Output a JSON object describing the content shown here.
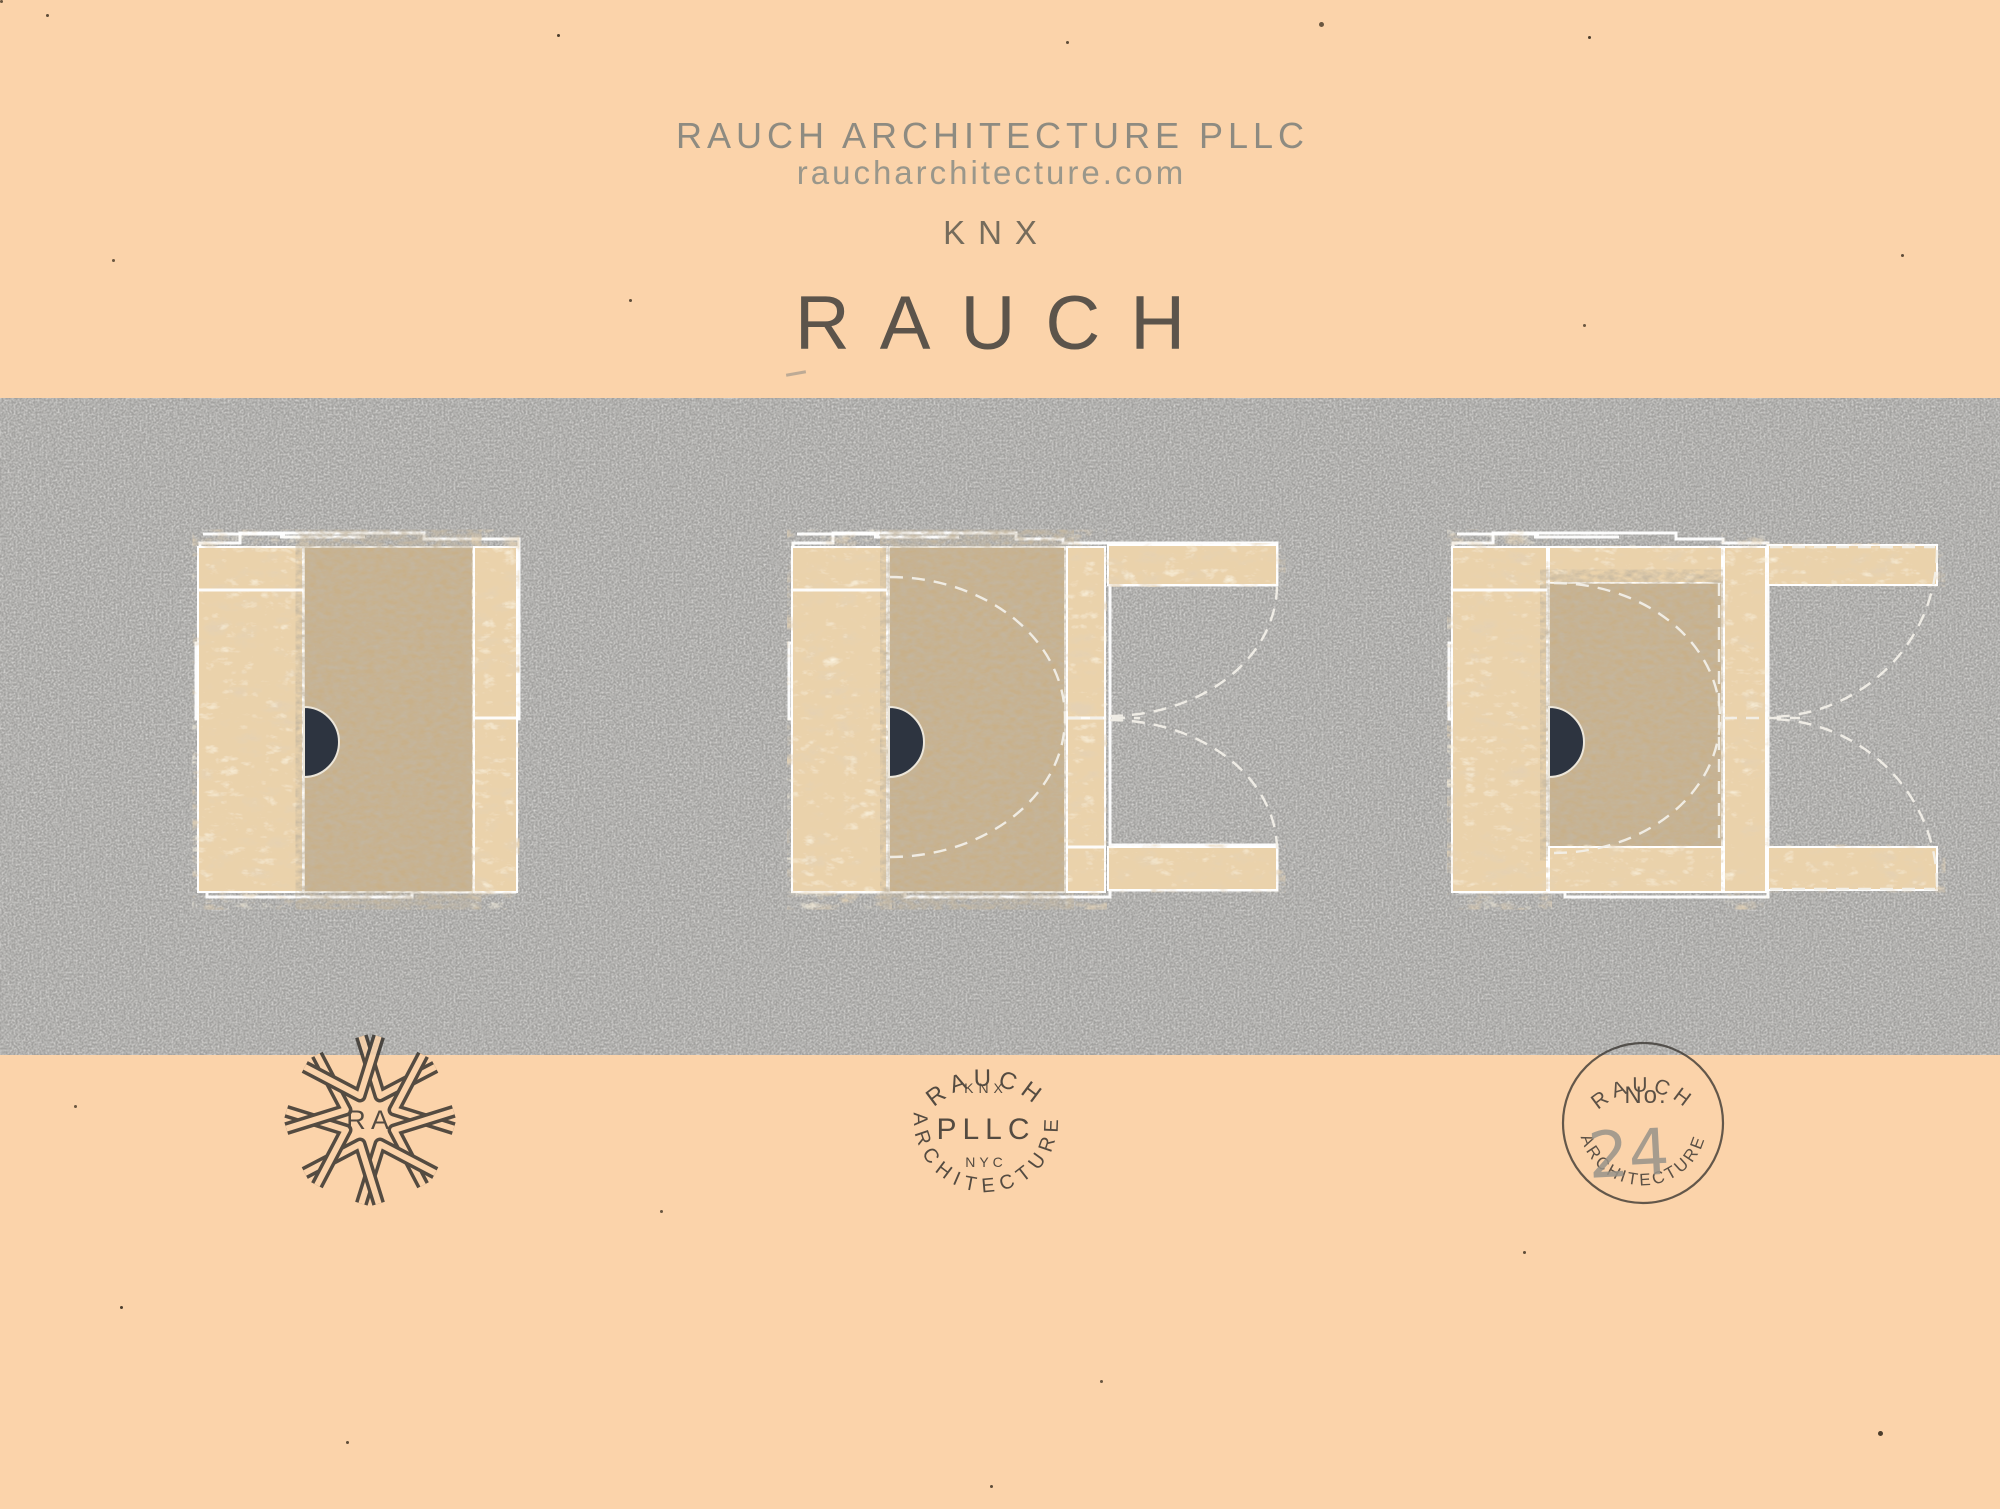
{
  "header": {
    "firm_name": "RAUCH ARCHITECTURE PLLC",
    "website": "raucharchitecture.com",
    "project_code": "KNX",
    "brand": "RAUCH",
    "city": "NYC"
  },
  "stamps": {
    "monogram": {
      "left_letter": "R",
      "right_letter": "A"
    },
    "seal": {
      "arc_top": "RAUCH",
      "small_top": "KNX",
      "center": "PLLC",
      "small_bottom": "NYC",
      "arc_bottom": "ARCHITECTURE"
    },
    "project_seal": {
      "arc_top": "RAUCH",
      "number_label": "No.",
      "number": "24",
      "arc_bottom": "ARCHITECTURE"
    }
  },
  "colors": {
    "paper": "#fbd3aa",
    "band": "#a2a19f",
    "osb": "#ead2ab",
    "kraft": "#c8b08a",
    "pull": "#2d3440",
    "cutline": "#ffffff",
    "ink": "#38342f",
    "pencil": "#98938a",
    "header_text": "#8e8b81",
    "header_sub": "#9a978b",
    "stamp_text": "#4f4a44"
  }
}
